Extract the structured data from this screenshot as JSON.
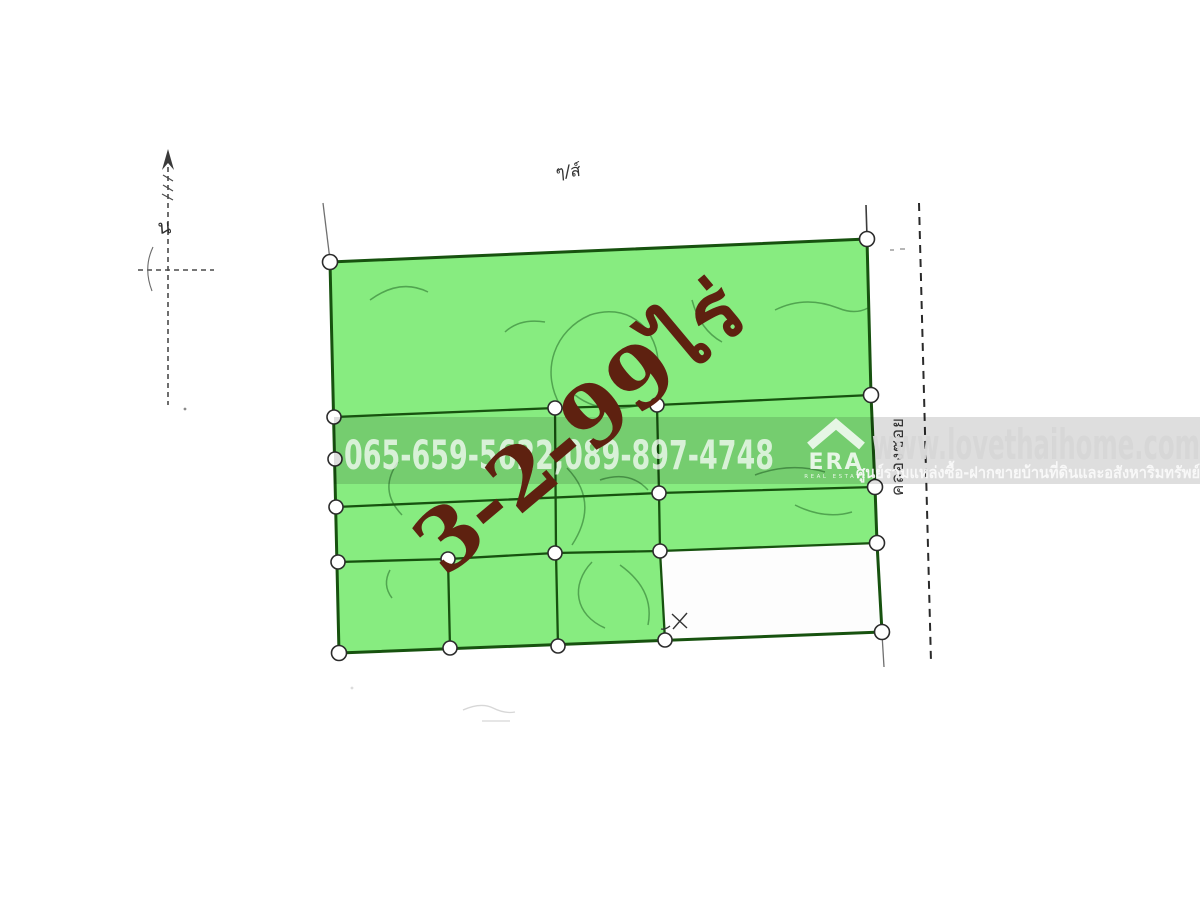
{
  "figure": {
    "north_label": "น",
    "sheet_note": "ๆ/ส์",
    "canal_label": "คลองซอย",
    "area_label": "3-2-99ไร่"
  },
  "watermark": {
    "phones": "065-659-5622,089-897-4748",
    "website": "www.lovethaihome.com",
    "tagline": "ศูนย์รวมแหล่งซื้อ-ฝากขายบ้านที่ดินและอสังหาริมทรัพย์",
    "brand": "ERA",
    "brand_sub": "REAL ESTATE"
  },
  "colors": {
    "highlight": "#87ec80",
    "boundary": "#17520f",
    "area_text": "#5e2110",
    "paper": "#ffffff"
  }
}
